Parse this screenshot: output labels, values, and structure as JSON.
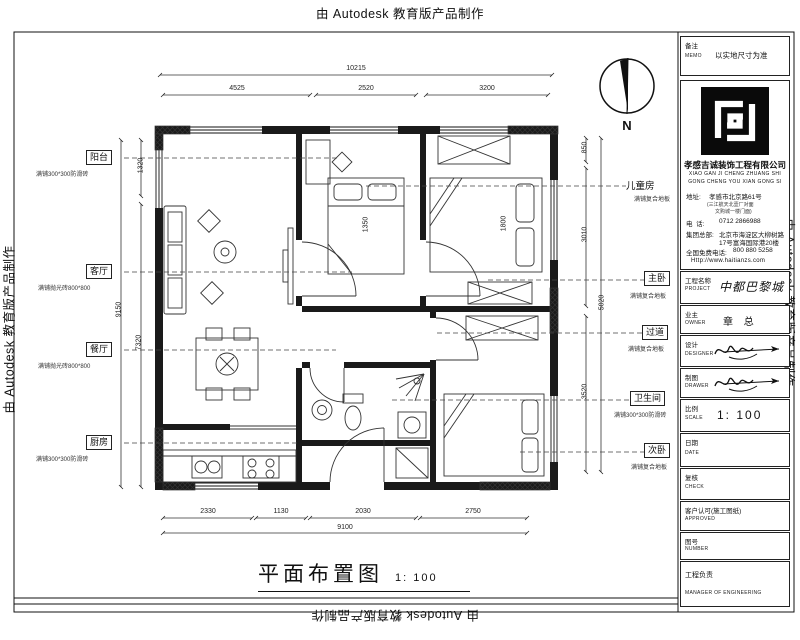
{
  "autodesk_credit": "由 Autodesk 教育版产品制作",
  "north_label": "N",
  "plan": {
    "title": "平面布置图",
    "title_scale": "1: 100",
    "rooms": [
      {
        "name": "阳台",
        "material": "满铺300*300防滑砖"
      },
      {
        "name": "客厅",
        "material": "满铺抛光砖800*800"
      },
      {
        "name": "餐厅",
        "material": "满铺抛光砖800*800"
      },
      {
        "name": "厨房",
        "material": "满铺300*300防滑砖"
      },
      {
        "name": "儿童房",
        "material": "满铺复合地板"
      },
      {
        "name": "主卧",
        "material": "满铺复合地板"
      },
      {
        "name": "过道",
        "material": "满铺复合地板"
      },
      {
        "name": "卫生间",
        "material": "满铺300*300防滑砖"
      },
      {
        "name": "次卧",
        "material": "满铺复合地板"
      }
    ],
    "dimensions": {
      "top_total": "10215",
      "top_segments": [
        "4525",
        "2520",
        "3200"
      ],
      "bottom_segments": [
        "2330",
        "1130",
        "2030",
        "2750"
      ],
      "bottom_total": "9100",
      "left": [
        "1320",
        "9150",
        "7320"
      ],
      "right": [
        "850",
        "3010",
        "5020",
        "3520"
      ],
      "bed_master": "1800",
      "bed_child": "1350"
    }
  },
  "titleblock": {
    "memo_label": "备注",
    "memo_en": "MEMO",
    "memo_value": "以实地尺寸为准",
    "company": {
      "name": "孝感吉诚装饰工程有限公司",
      "pinyin1": "XIAO GAN JI CHENG ZHUANG SHI",
      "pinyin2": "GONG CHENG YOU XIAN GONG SI",
      "address_label": "地址:",
      "address": "孝感市北京路61号",
      "address_note1": "(三江航天北壹厂对面",
      "address_note2": "文购城一楼门面)",
      "phone_label": "电  话:",
      "phone": "0712 2866988",
      "hq_label": "集团总部:",
      "hq_line1": "北京市海淀区大柳树路",
      "hq_line2": "17号富海国际港20楼",
      "hotline_label": "全国免费电话:",
      "hotline": "800 880 5258",
      "website": "Http://www.haitianzs.com"
    },
    "rows": [
      {
        "label": "工程名称",
        "en": "PROJECT",
        "value": "中都巴黎城"
      },
      {
        "label": "业主",
        "en": "OWNER",
        "value": "章 总"
      },
      {
        "label": "设计",
        "en": "DESIGNER",
        "value": ""
      },
      {
        "label": "制图",
        "en": "DRAWER",
        "value": ""
      },
      {
        "label": "比例",
        "en": "SCALE",
        "value": "1: 100"
      },
      {
        "label": "日期",
        "en": "DATE",
        "value": ""
      },
      {
        "label": "复核",
        "en": "CHECK",
        "value": ""
      },
      {
        "label": "客户认可(施工图纸)",
        "en": "APPROVED",
        "value": ""
      },
      {
        "label": "图号",
        "en": "NUMBER",
        "value": ""
      },
      {
        "label": "工程负责",
        "en": "MANAGER OF ENGINEERING",
        "value": ""
      }
    ]
  }
}
